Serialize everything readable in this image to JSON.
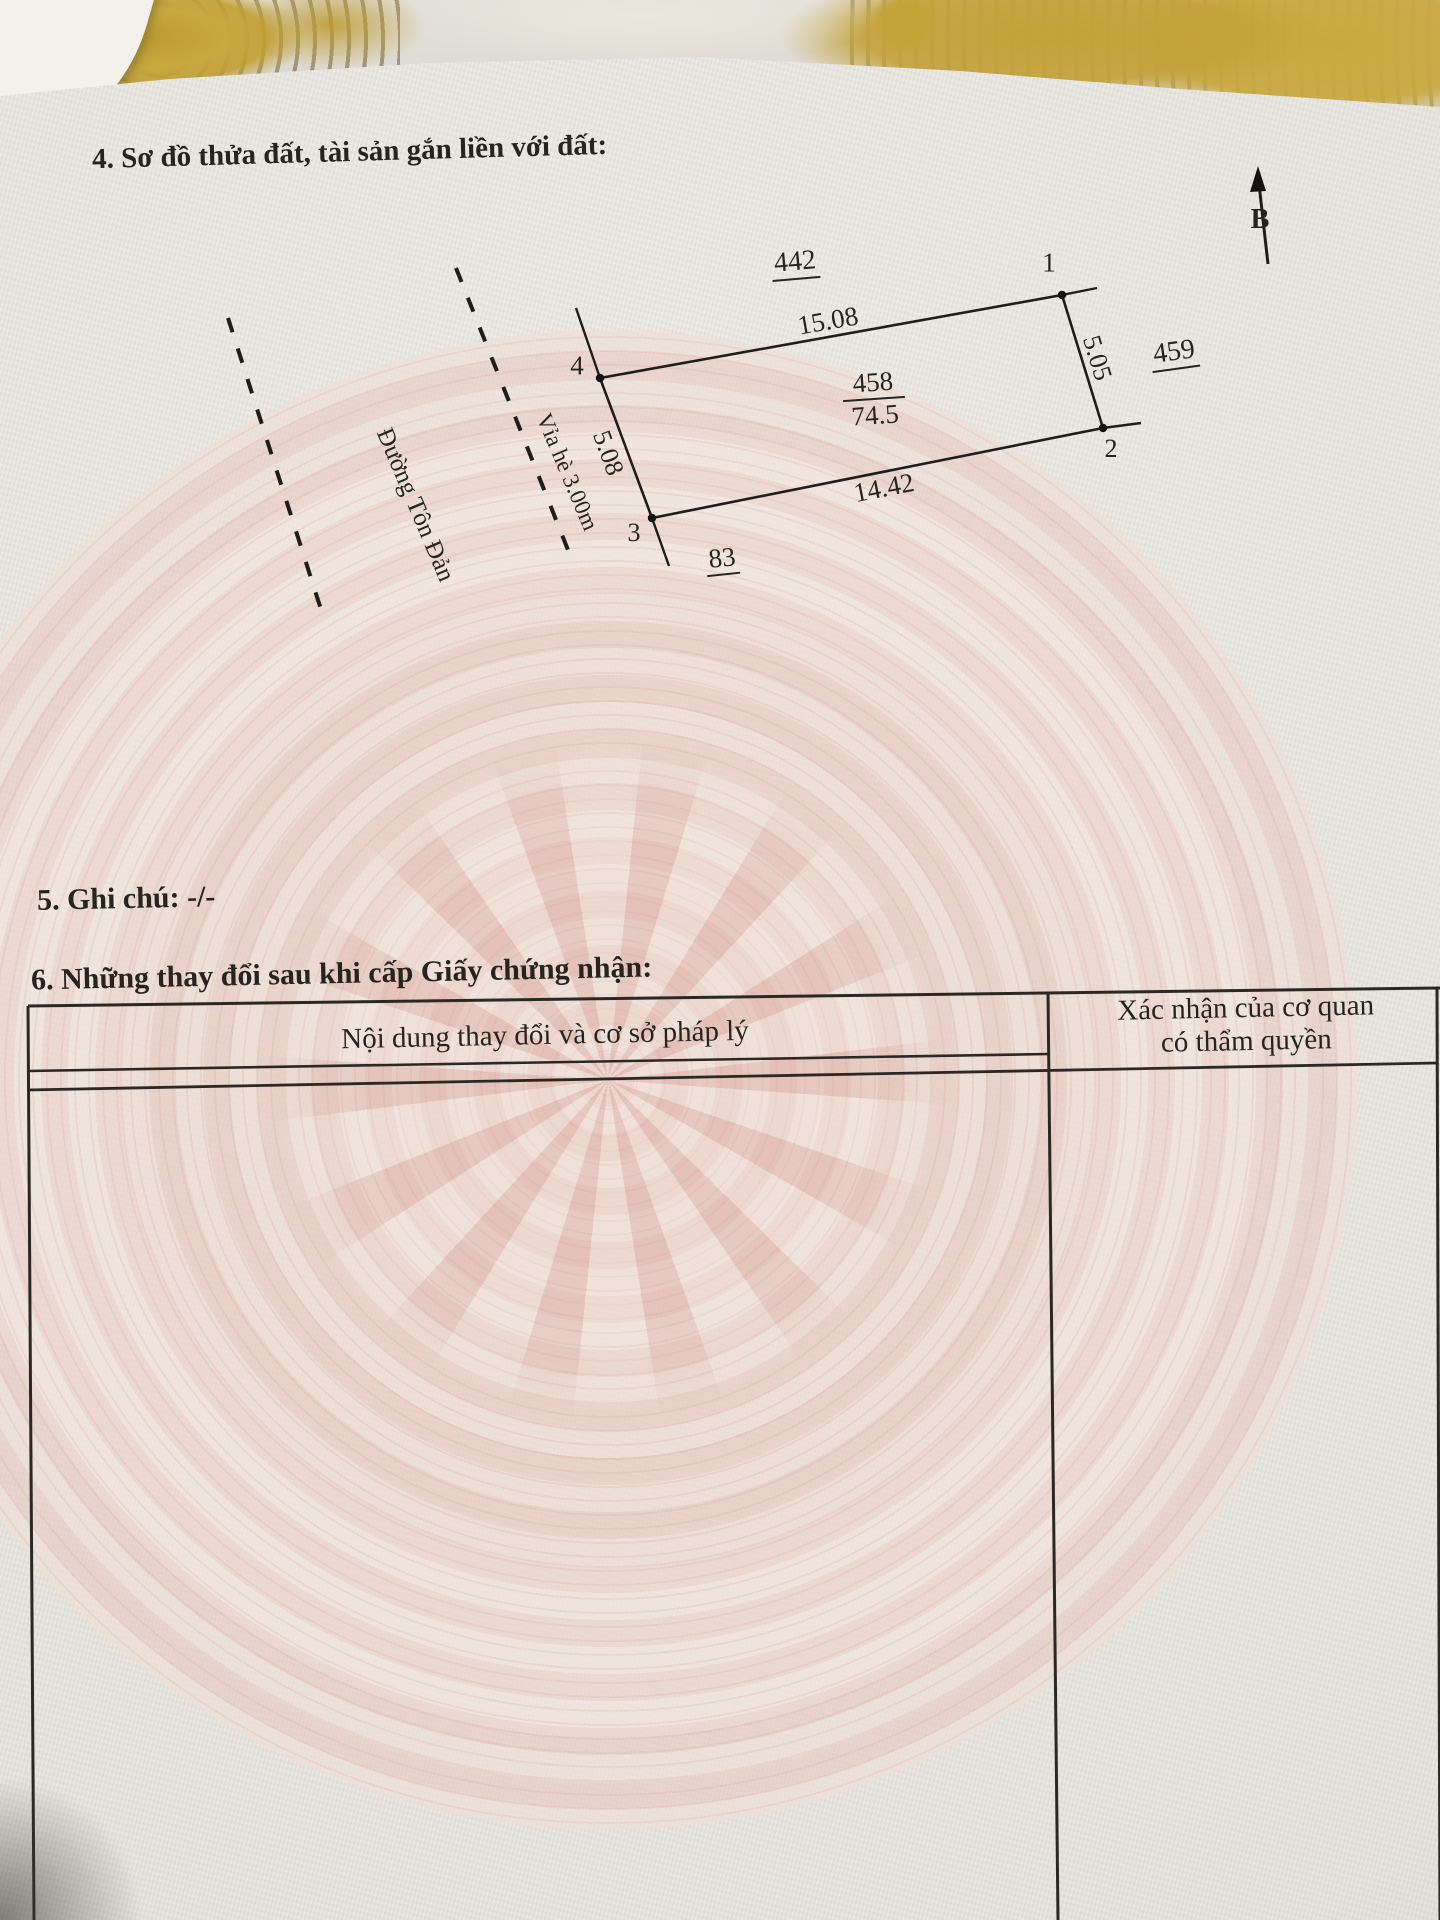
{
  "document": {
    "section4_title": "4. Sơ đồ thửa đất, tài sản gắn liền với đất:",
    "section5_text": "5. Ghi chú: -/-",
    "section6_title": "6. Những thay đổi sau khi cấp Giấy chứng nhận:"
  },
  "diagram": {
    "north_label": "B",
    "adjacent_plot_top": "442",
    "adjacent_plot_right": "459",
    "adjacent_plot_bottom": "83",
    "parcel_number": "458",
    "parcel_area": "74.5",
    "edge_top_length": "15.08",
    "edge_right_length": "5.05",
    "edge_bottom_length": "14.42",
    "edge_left_length": "5.08",
    "corner_1": "1",
    "corner_2": "2",
    "corner_3": "3",
    "corner_4": "4",
    "street_label": "Đường Tôn Đản",
    "sidewalk_label": "Vỉa hè 3.00m"
  },
  "table": {
    "col1_header": "Nội dung thay đổi và cơ sở pháp lý",
    "col2_header_line1": "Xác nhận của cơ quan",
    "col2_header_line2": "có thẩm quyền"
  },
  "colors": {
    "ink": "#26241f",
    "paper": "#e6e4de",
    "drum_pink": "#e8cfc9",
    "doily_gold": "#c2a035"
  }
}
